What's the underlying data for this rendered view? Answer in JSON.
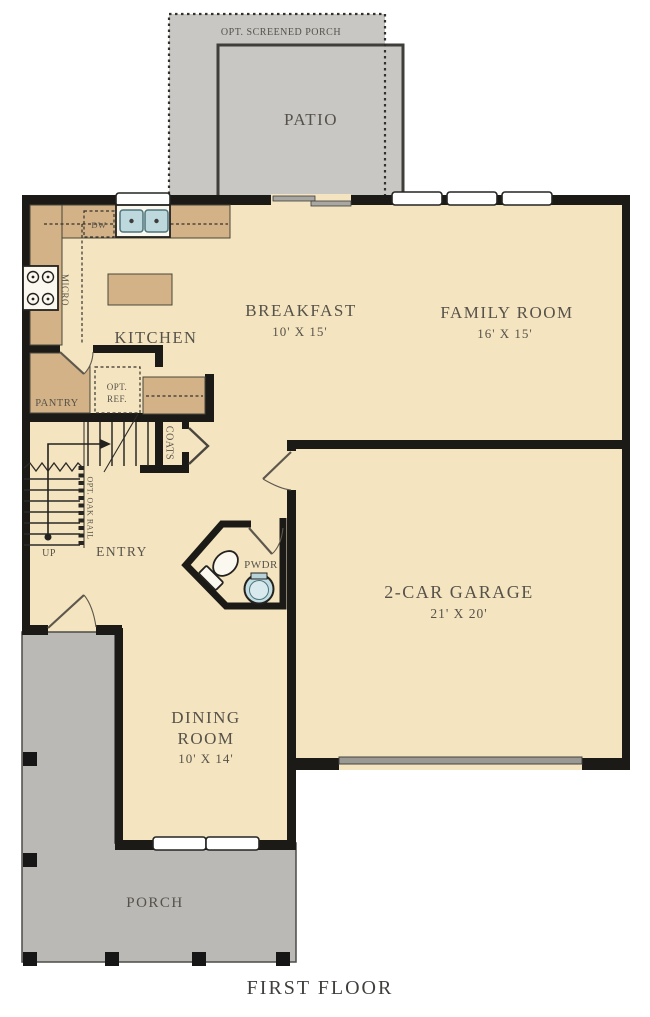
{
  "caption": "FIRST FLOOR",
  "colors": {
    "floor": "#f4e5c0",
    "counter": "#d2b286",
    "porch": "#bab9b6",
    "patio": "#c8c7c3",
    "wall": "#1b1a17",
    "label": "#56524a",
    "fixture-blue": "#bdd9de",
    "paper": "#ffffff"
  },
  "rooms": {
    "screened_porch": {
      "label": "OPT. SCREENED PORCH"
    },
    "patio": {
      "label": "PATIO"
    },
    "kitchen": {
      "label": "KITCHEN"
    },
    "breakfast": {
      "label": "BREAKFAST",
      "dims": "10' X 15'"
    },
    "family_room": {
      "label": "FAMILY ROOM",
      "dims": "16' X 15'"
    },
    "pantry": {
      "label": "PANTRY"
    },
    "entry": {
      "label": "ENTRY"
    },
    "powder_room": {
      "label": "PWDR"
    },
    "garage": {
      "label": "2-CAR GARAGE",
      "dims": "21' X 20'"
    },
    "dining_room": {
      "line1": "DINING",
      "line2": "ROOM",
      "dims": "10' X 14'"
    },
    "porch": {
      "label": "PORCH"
    }
  },
  "annotations": {
    "dishwasher": "DW",
    "microwave": "MICRO",
    "opt_ref_line1": "OPT.",
    "opt_ref_line2": "REF.",
    "coats": "COATS",
    "stairs_up": "UP",
    "oak_rail": "OPT. OAK RAIL"
  }
}
